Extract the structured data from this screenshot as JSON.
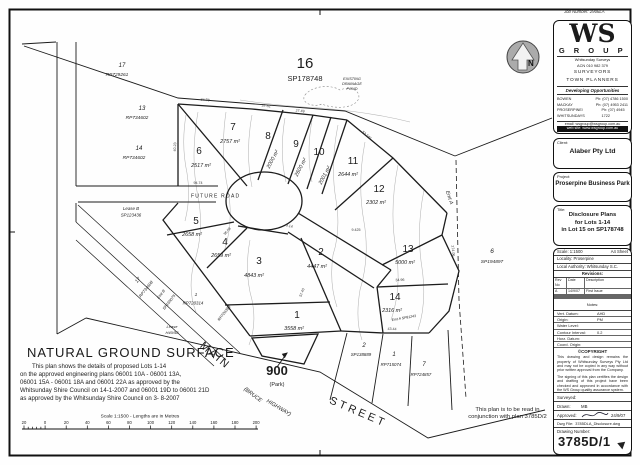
{
  "page": {
    "job_number": "Job Number: 2906LA"
  },
  "north": {
    "label": "N"
  },
  "firm": {
    "logo": "WS",
    "group": "G R O U P",
    "line1": "Whitsunday Surveys",
    "line2": "ACN 010 982 379",
    "role1": "SURVEYORS",
    "role2": "TOWN PLANNERS",
    "tagline": "Developing Opportunities",
    "contacts": [
      {
        "office": "BOWEN",
        "phone": "Ph: (07) 4786 1500"
      },
      {
        "office": "MACKAY",
        "phone": "Ph: (07) 4953 2411"
      },
      {
        "office": "PROSERPINE/ WHITSUNDAYS",
        "phone": "Ph: (07) 4945 1722"
      }
    ],
    "email": "email: wsgroup@wsgroup.com.au",
    "web": "web site: www.wsgroup.com.au"
  },
  "titleblock": {
    "client_label": "Client:",
    "client": "Alaber Pty Ltd",
    "project_label": "Project:",
    "project": "Proserpine Business Park",
    "title_label": "Title:",
    "title_lines": [
      "Disclosure Plans",
      "for Lots 1-14",
      "in Lot 15 on SP178748"
    ],
    "scale_label": "Scale: 1:1500",
    "sheet": "A4 Sheet",
    "locality": "Locality: Proserpine",
    "authority": "Local Authority: Whitsunday S.C.",
    "revisions": {
      "heading": "Revisions:",
      "columns": [
        "Rev No",
        "Date",
        "Description"
      ],
      "rows": [
        [
          "A",
          "14/9/07",
          "First Issue"
        ]
      ],
      "notes": "Notes:"
    },
    "datum_rows": [
      [
        "Vert. Datum:",
        "AHD"
      ],
      [
        "Origin:",
        "PM"
      ],
      [
        "Water Level:",
        ""
      ],
      [
        "Contour Interval:",
        "0.2"
      ],
      [
        "Horz. Datum:",
        ""
      ],
      [
        "Coord. Origin:",
        ""
      ]
    ],
    "copyright_heading": "©COPYRIGHT",
    "copyright_text": "This drawing and design remains the property of Whitsunday Surveys Pty Ltd and may not be copied in any way without prior written approval from the Company.",
    "qa_text": "The signing of this plan certifies the design and drafting of this project have been checked and approved in accordance with the WS Group quality assurance system.",
    "sign_rows": [
      [
        "Surveyed:",
        ""
      ],
      [
        "Drawn:",
        "MB"
      ],
      [
        "Approved:",
        "24/9/07"
      ]
    ],
    "dwg_label": "Dwg File:",
    "dwg_file": "3785DLA_Disclosure.dwg",
    "drawing_number_label": "Drawing Number:",
    "drawing_number": "3785D/1"
  },
  "plan": {
    "lots": [
      {
        "n": "1",
        "area": "3558 m²"
      },
      {
        "n": "2",
        "area": "4447 m²"
      },
      {
        "n": "3",
        "area": "4843 m²"
      },
      {
        "n": "4",
        "area": "2659 m²"
      },
      {
        "n": "5",
        "area": "2658 m²"
      },
      {
        "n": "6",
        "area": "2517 m²"
      },
      {
        "n": "7",
        "area": "2757 m²"
      },
      {
        "n": "8",
        "area": "2000 m²"
      },
      {
        "n": "9",
        "area": "2600 m²"
      },
      {
        "n": "10",
        "area": "2001 m²"
      },
      {
        "n": "11",
        "area": "2644 m²"
      },
      {
        "n": "12",
        "area": "2302 m²"
      },
      {
        "n": "13",
        "area": "5000 m²"
      },
      {
        "n": "14",
        "area": "2316 m²"
      }
    ],
    "labels": [
      "17",
      "RP729261",
      "13",
      "RP734602",
      "14",
      "RP734602",
      "Lease B",
      "SP123436",
      "16",
      "SP178748",
      "EXISTING",
      "DRAINAGE",
      "POND",
      "6",
      "SP194897",
      "Emt A",
      "2",
      "SP138889",
      "1",
      "RP715074",
      "7",
      "RP724857",
      "17",
      "RP734608",
      "Emt B",
      "SP195075",
      "1",
      "RP720314",
      "Lease",
      "H40/58",
      "900",
      "(Park)",
      "MAIN",
      "STREET",
      "(BRUCE",
      "HIGHWAY)",
      "FUTURE ROAD",
      "RP720363",
      "Emt A SP81243"
    ],
    "dims": [
      "84.78",
      "37.32",
      "27.49",
      "53.240",
      "274.06",
      "94.74",
      "36.58",
      "57.40",
      "34.96",
      "43.44",
      "40.23",
      "9.425",
      "9.14"
    ]
  },
  "footer": {
    "heading": "NATURAL GROUND SURFACE",
    "note_lines": [
      "This plan shows the details of proposed Lots 1-14",
      "on the approved engineering plans 06001 10A - 06001 13A,",
      "06001 15A - 06001 18A and 06001 22A as approved by the",
      "Whitsunday Shire Council on 14-1-2007 and 06001 19D to 06001 21D",
      "as approved by the Whitsunday Shire Council on 3- 8-2007"
    ],
    "scalebar": {
      "caption": "Scale 1:1500 - Lengths are in Metres",
      "ticks": [
        "20",
        "0",
        "20",
        "40",
        "60",
        "80",
        "100",
        "120",
        "140",
        "160",
        "180",
        "200"
      ]
    },
    "conjunction_lines": [
      "This plan is to be read in",
      "conjunction with plan 3785D/2"
    ]
  }
}
